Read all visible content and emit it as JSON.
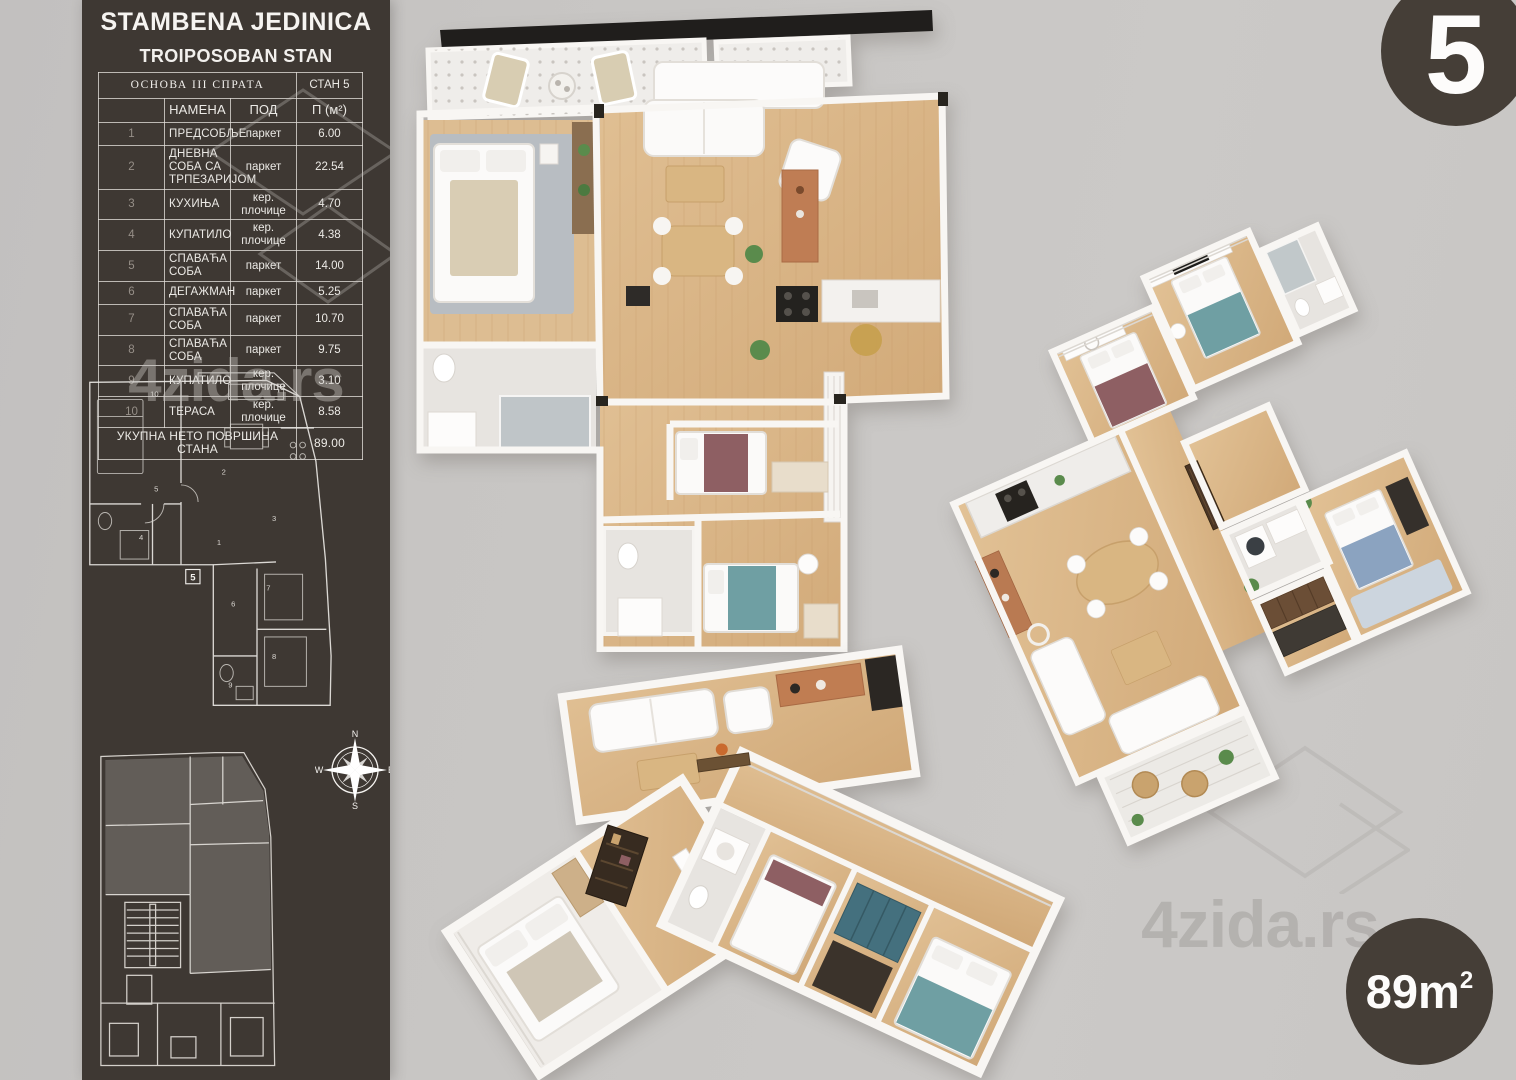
{
  "watermark": {
    "text": "4zida.rs"
  },
  "badges": {
    "unit_number": "5",
    "area_value": "89m",
    "area_sup": "2"
  },
  "sidebar": {
    "title": "STAMBENA JEDINICA",
    "subtitle": "TROIPOSOBAN STAN",
    "table": {
      "header_left": "ОСНОВА III СПРАТА",
      "header_right": "СТАН 5",
      "columns": [
        "НАМЕНА",
        "ПОД",
        "П (м²)"
      ],
      "rows": [
        {
          "num": "1",
          "name": "ПРЕДСОБЉЕ",
          "floor": "паркет",
          "area": "6.00"
        },
        {
          "num": "2",
          "name": "ДНЕВНА СОБА СА ТРПЕЗАРИЈОМ",
          "floor": "паркет",
          "area": "22.54"
        },
        {
          "num": "3",
          "name": "КУХИЊА",
          "floor": "кер. плочице",
          "area": "4.70"
        },
        {
          "num": "4",
          "name": "КУПАТИЛО",
          "floor": "кер. плочице",
          "area": "4.38"
        },
        {
          "num": "5",
          "name": "СПАВАЋА СОБА",
          "floor": "паркет",
          "area": "14.00"
        },
        {
          "num": "6",
          "name": "ДЕГАЖМАН",
          "floor": "паркет",
          "area": "5.25"
        },
        {
          "num": "7",
          "name": "СПАВАЋА СОБА",
          "floor": "паркет",
          "area": "10.70"
        },
        {
          "num": "8",
          "name": "СПАВАЋА СОБА",
          "floor": "паркет",
          "area": "9.75"
        },
        {
          "num": "9",
          "name": "КУПАТИЛО",
          "floor": "кер. плочице",
          "area": "3.10"
        },
        {
          "num": "10",
          "name": "ТЕРАСА",
          "floor": "кер. плочице",
          "area": "8.58"
        }
      ],
      "footer_label": "УКУПНА НЕТО ПОВРШИНА СТАНА",
      "footer_value": "89.00"
    },
    "plan": {
      "unit_box_label": "5",
      "room_markers": [
        "1",
        "2",
        "3",
        "4",
        "5",
        "6",
        "7",
        "8",
        "9",
        "10"
      ]
    },
    "compass": {
      "north": "N",
      "east": "E",
      "south": "S",
      "west": "W"
    }
  }
}
